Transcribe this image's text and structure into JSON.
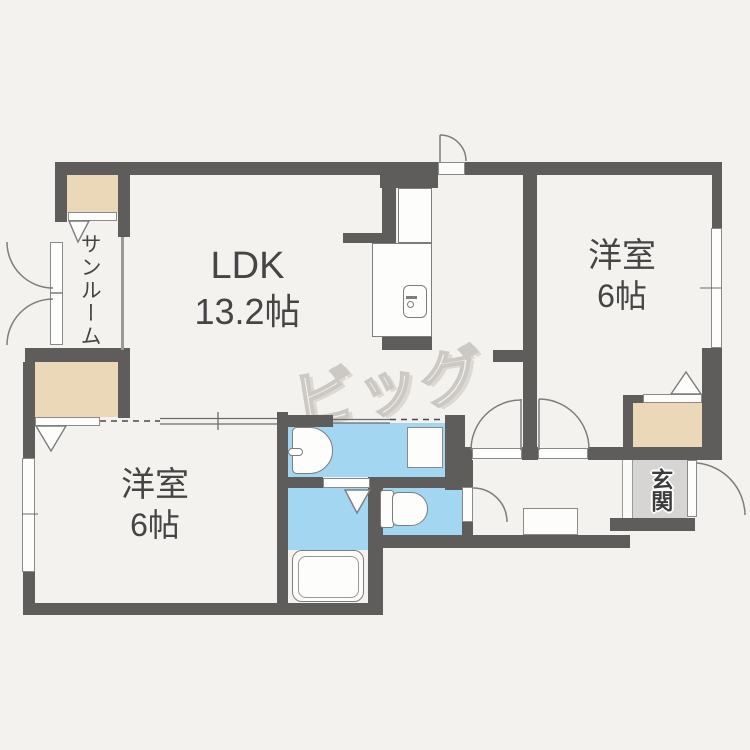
{
  "page": {
    "title": "2LDK間取り図",
    "type": "floor-plan"
  },
  "rooms": {
    "ldk": {
      "label": "LDK",
      "size": "13.2帖"
    },
    "bedroom_right": {
      "label": "洋室",
      "size": "6帖"
    },
    "bedroom_left": {
      "label": "洋室",
      "size": "6帖"
    },
    "sunroom": {
      "label": "サンルーム"
    },
    "entrance": {
      "label": "玄関"
    }
  },
  "watermark": {
    "text": "ビッグ"
  },
  "fixtures": [
    "kitchen-counter",
    "kitchen-sink",
    "washing-machine-pan",
    "washbasin",
    "bathtub",
    "toilet",
    "shoe-cabinet",
    "window",
    "folding-door",
    "sliding-door",
    "hinged-door",
    "closet"
  ],
  "colors": {
    "wall": "#5e5d5b",
    "water_area": "#a3d6f0",
    "closet_beige": "#ead8b8",
    "entrance_floor": "#d6d5d3",
    "background": "#f4f2ef"
  }
}
